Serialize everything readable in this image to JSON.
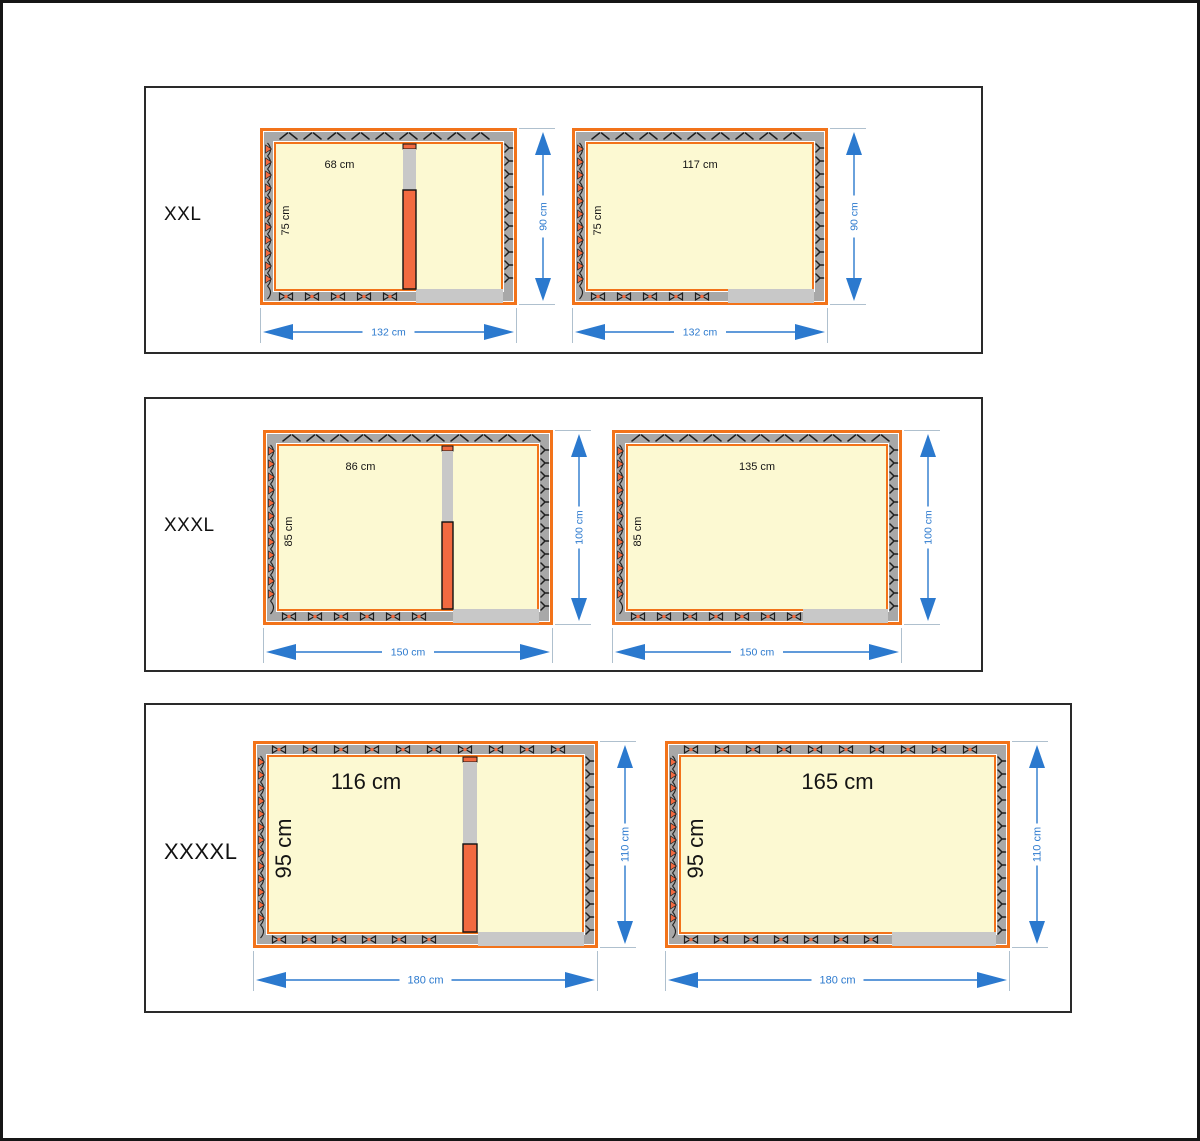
{
  "colors": {
    "orange_border": "#F2731A",
    "divider_orange": "#F26A40",
    "wall_gray": "#A8A8A8",
    "light_gray": "#C8C8C8",
    "interior_yellow": "#FCF9D2",
    "dimension_blue": "#2B79CE",
    "extension_gray": "#AFC0CE",
    "hatch_black": "#1E1E1E",
    "panel_border": "#2A2A2A",
    "label_black": "#141414"
  },
  "rows": [
    {
      "size_label": "XXL",
      "interior_font_px": 11,
      "dim_font_px": 10.5,
      "hdim_offset": 27,
      "vdim_offset": 26,
      "plans": [
        {
          "name": "xxl-two-room",
          "kind": "divided",
          "x": 260,
          "y": 128,
          "w": 257,
          "h": 177,
          "interior_width_label": "68 cm",
          "interior_height_label": "75 cm",
          "outer_width_label": "132 cm",
          "outer_height_label": "90 cm",
          "interior_width_cm": 68,
          "interior_height_cm": 75,
          "outer_width_cm": 132,
          "outer_height_cm": 90,
          "divider_x": 143,
          "divider_w": 13,
          "divider_gray_frac": 0.29,
          "entrance_start": 156,
          "top_pattern": "chevron"
        },
        {
          "name": "xxl-one-room",
          "kind": "open",
          "x": 572,
          "y": 128,
          "w": 256,
          "h": 177,
          "interior_width_label": "117 cm",
          "interior_height_label": "75 cm",
          "outer_width_label": "132 cm",
          "outer_height_label": "90 cm",
          "interior_width_cm": 117,
          "interior_height_cm": 75,
          "outer_width_cm": 132,
          "outer_height_cm": 90,
          "entrance_start": 156,
          "top_pattern": "chevron"
        }
      ]
    },
    {
      "size_label": "XXXL",
      "interior_font_px": 11,
      "dim_font_px": 10.5,
      "hdim_offset": 27,
      "vdim_offset": 26,
      "plans": [
        {
          "name": "xxxl-two-room",
          "kind": "divided",
          "x": 263,
          "y": 430,
          "w": 290,
          "h": 195,
          "interior_width_label": "86 cm",
          "interior_height_label": "85 cm",
          "outer_width_label": "150 cm",
          "outer_height_label": "100 cm",
          "interior_width_cm": 86,
          "interior_height_cm": 85,
          "outer_width_cm": 150,
          "outer_height_cm": 100,
          "divider_x": 179,
          "divider_w": 11,
          "divider_gray_frac": 0.45,
          "entrance_start": 190,
          "top_pattern": "chevron"
        },
        {
          "name": "xxxl-one-room",
          "kind": "open",
          "x": 612,
          "y": 430,
          "w": 290,
          "h": 195,
          "interior_width_label": "135 cm",
          "interior_height_label": "85 cm",
          "outer_width_label": "150 cm",
          "outer_height_label": "100 cm",
          "interior_width_cm": 135,
          "interior_height_cm": 85,
          "outer_width_cm": 150,
          "outer_height_cm": 100,
          "entrance_start": 191,
          "top_pattern": "chevron"
        }
      ]
    },
    {
      "size_label": "XXXXL",
      "interior_font_px": 22,
      "dim_font_px": 11,
      "hdim_offset": 32,
      "vdim_offset": 27,
      "plans": [
        {
          "name": "xxxxl-two-room",
          "kind": "divided",
          "x": 253,
          "y": 741,
          "w": 345,
          "h": 207,
          "interior_width_label": "116 cm",
          "interior_height_label": "95 cm",
          "outer_width_label": "180 cm",
          "outer_height_label": "110 cm",
          "interior_width_cm": 116,
          "interior_height_cm": 95,
          "outer_width_cm": 180,
          "outer_height_cm": 110,
          "divider_x": 210,
          "divider_w": 14,
          "divider_gray_frac": 0.48,
          "entrance_start": 225,
          "top_pattern": "bowtie"
        },
        {
          "name": "xxxxl-one-room",
          "kind": "open",
          "x": 665,
          "y": 741,
          "w": 345,
          "h": 207,
          "interior_width_label": "165 cm",
          "interior_height_label": "95 cm",
          "outer_width_label": "180 cm",
          "outer_height_label": "110 cm",
          "interior_width_cm": 165,
          "interior_height_cm": 95,
          "outer_width_cm": 180,
          "outer_height_cm": 110,
          "entrance_start": 227,
          "top_pattern": "bowtie"
        }
      ]
    }
  ]
}
